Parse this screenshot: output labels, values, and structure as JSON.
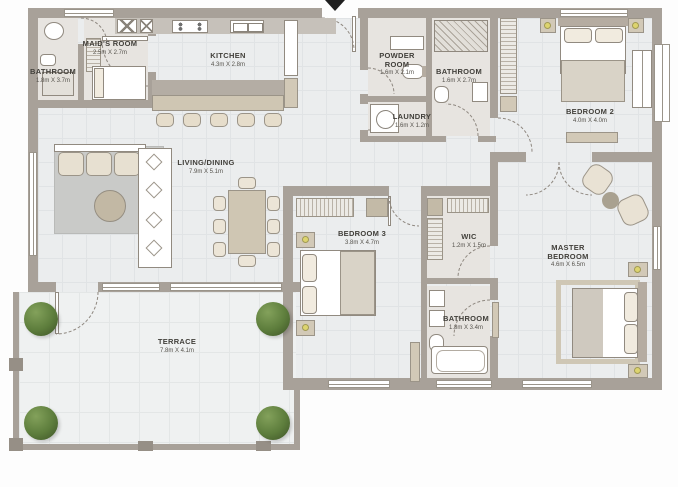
{
  "rooms": {
    "bathroom_maids": {
      "name": "BATHROOM",
      "dims": "1.8m X 3.7m"
    },
    "maids_room": {
      "name": "MAID'S ROOM",
      "dims": "2.5m X 2.7m"
    },
    "kitchen": {
      "name": "KITCHEN",
      "dims": "4.3m X 2.8m"
    },
    "powder_room": {
      "name": "POWDER ROOM",
      "dims": "1.6m X 2.1m"
    },
    "laundry": {
      "name": "LAUNDRY",
      "dims": "1.6m X 1.2m"
    },
    "bathroom_2": {
      "name": "BATHROOM",
      "dims": "1.6m X 2.7m"
    },
    "bedroom_2": {
      "name": "BEDROOM 2",
      "dims": "4.0m X 4.0m"
    },
    "living_dining": {
      "name": "LIVING/DINING",
      "dims": "7.9m X 5.1m"
    },
    "bedroom_3": {
      "name": "BEDROOM 3",
      "dims": "3.8m X 4.7m"
    },
    "wic": {
      "name": "WIC",
      "dims": "1.2m X 1.5m"
    },
    "master_bedroom": {
      "name": "MASTER BEDROOM",
      "dims": "4.6m X 6.5m"
    },
    "bathroom_master": {
      "name": "BATHROOM",
      "dims": "1.8m X 3.4m"
    },
    "terrace": {
      "name": "TERRACE",
      "dims": "7.8m X 4.1m"
    }
  },
  "colors": {
    "wall": "#a8a199",
    "floor": "#ebedee",
    "furniture_beige": "#d2c9b7",
    "hatch_gray": "#b9b2a7",
    "plant_green": "#5d7d3c",
    "lamp_yellow": "#ddd46f"
  }
}
